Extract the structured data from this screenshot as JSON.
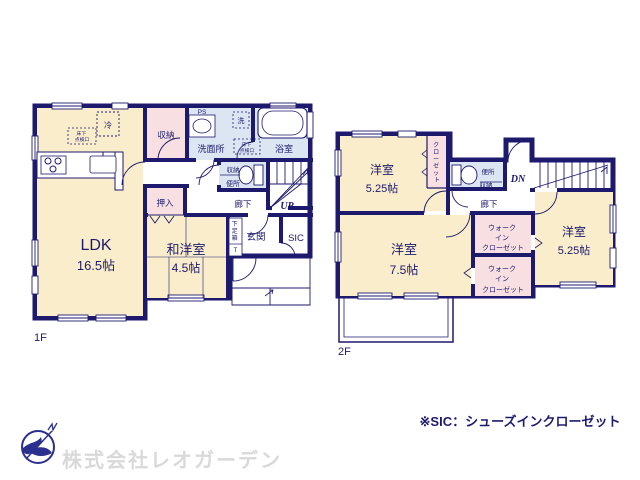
{
  "colors": {
    "wall": "#1d1a6e",
    "room_cream": "#f9edcb",
    "closet_pink": "#f8dfe2",
    "wet_blue": "#dce6f3",
    "logo_navy": "#2b2f8e",
    "company_gray": "#d9d9d9"
  },
  "floor1": {
    "label": "1F",
    "ldk": {
      "name": "LDK",
      "size": "16.5帖"
    },
    "washitsu": {
      "name": "和洋室",
      "size": "4.5帖"
    },
    "storage_top": "収納",
    "oshiire": "押入",
    "ps": "PS",
    "senmenjo": "洗面所",
    "laundry": "洗",
    "bath": "浴室",
    "fridge": "冷",
    "underfloor": [
      "床下",
      "点検口"
    ],
    "underfloor2": [
      "床下",
      "点検口"
    ],
    "toilet_storage": "収納",
    "toilet": "便所",
    "hall": "廊下",
    "up": "UP",
    "shoe_box": [
      "下",
      "足",
      "箱",
      "T"
    ],
    "genkan": "玄関",
    "sic": "SIC"
  },
  "floor2": {
    "label": "2F",
    "room1": {
      "name": "洋室",
      "size": "5.25帖"
    },
    "room2": {
      "name": "洋室",
      "size": "7.5帖"
    },
    "room3": {
      "name": "洋室",
      "size": "5.25帖"
    },
    "closet_chars": [
      "ク",
      "ロ",
      "ー",
      "ゼ",
      "ッ",
      "ト"
    ],
    "toilet": "便所",
    "storage": "収納",
    "dn": "DN",
    "hall": "廊下",
    "wic": [
      "ウォーク",
      "イン",
      "クローゼット"
    ]
  },
  "footer": {
    "company": "株式会社レオガーデン",
    "note": "※SIC：シューズインクローゼット"
  }
}
